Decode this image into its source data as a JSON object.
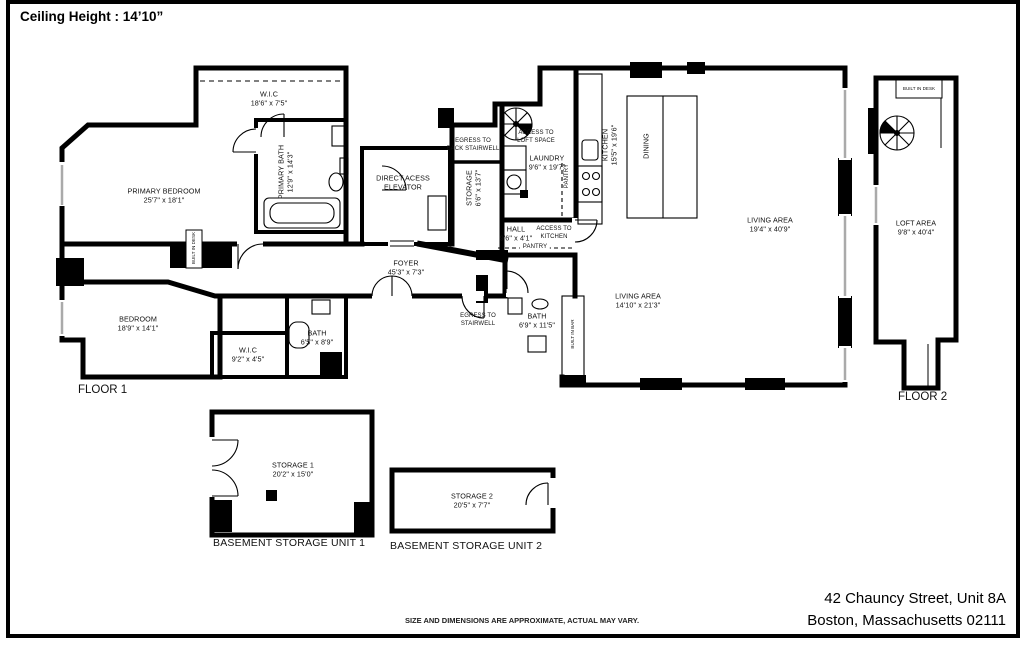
{
  "header": {
    "ceiling_height": "Ceiling Height : 14’10”"
  },
  "floor1": {
    "floor_label": "FLOOR 1",
    "primary_bedroom": [
      "PRIMARY BEDROOM",
      "25'7\" x 18'1\""
    ],
    "wic_top": [
      "W.I.C",
      "18'6\" x 7'5\""
    ],
    "primary_bath": [
      "PRIMARY BATH",
      "12'9\" x 14'3\""
    ],
    "elevator": [
      "DIRECT ACESS",
      "ELEVATOR"
    ],
    "egress_back_stairwell": [
      "EGRESS TO",
      "BACK STAIRWELL"
    ],
    "storage": [
      "STORAGE",
      "6'6\" x 13'7\""
    ],
    "access_loft": [
      "ACCESS TO",
      "LOFT SPACE"
    ],
    "laundry": [
      "LAUNDRY",
      "9'6\" x 19'7\""
    ],
    "kitchen": [
      "KITCHEN",
      "15'5\" x 19'6\""
    ],
    "pantry_kitchen": [
      "PANTRY"
    ],
    "dining": [
      "DINING"
    ],
    "living_main": [
      "LIVING AREA",
      "19'4\" x 40'9\""
    ],
    "hall": [
      "HALL",
      "9'6\" x 4'1\""
    ],
    "access_kitchen": [
      "ACCESS TO",
      "KITCHEN"
    ],
    "pantry_hall": [
      "PANTRY"
    ],
    "foyer": [
      "FOYER",
      "45'3\" x 7'3\""
    ],
    "egress_stairwell": [
      "EGRESS TO",
      "STAIRWELL"
    ],
    "bath_hall": [
      "BATH",
      "6'9\" x 11'5\""
    ],
    "built_in_bar": [
      "BUILT IN BAR"
    ],
    "living_second": [
      "LIVING AREA",
      "14'10\" x 21'3\""
    ],
    "bedroom": [
      "BEDROOM",
      "18'9\" x 14'1\""
    ],
    "wic_bedroom": [
      "W.I.C",
      "9'2\" x 4'5\""
    ],
    "bath_bedroom": [
      "BATH",
      "6'5\" x 8'9\""
    ],
    "built_in_desk": [
      "BUILT IN DESK"
    ]
  },
  "floor2": {
    "floor_label": "FLOOR 2",
    "loft": [
      "LOFT AREA",
      "9'8\" x 40'4\""
    ],
    "built_in_desk": [
      "BUILT IN DESK"
    ]
  },
  "basement": {
    "storage1": [
      "STORAGE 1",
      "20'2\" x 15'0\""
    ],
    "unit1_caption": "BASEMENT STORAGE UNIT 1",
    "storage2": [
      "STORAGE 2",
      "20'5\" x 7'7\""
    ],
    "unit2_caption": "BASEMENT STORAGE UNIT 2"
  },
  "footer": {
    "disclaimer": "SIZE AND DIMENSIONS ARE APPROXIMATE, ACTUAL MAY VARY.",
    "address_line1": "42 Chauncy Street, Unit 8A",
    "address_line2": "Boston, Massachusetts 02111"
  }
}
